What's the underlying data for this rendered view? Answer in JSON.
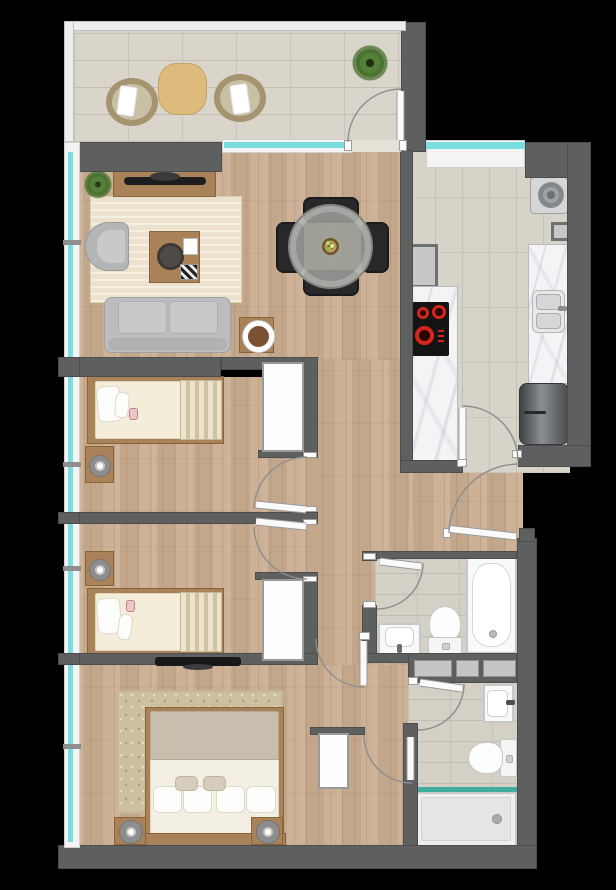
{
  "meta": {
    "title": "apartment-floor-plan",
    "view": "top-down 2D architectural floor plan with rendered furniture",
    "canvas_px": "616x890",
    "background": "#000000",
    "visible_text": ""
  },
  "palette": {
    "wall": "#5e5f5f",
    "wood_floor": "#c9ad90",
    "living_rug": "#ebe1cc",
    "balcony_tile": "#d9d5cb",
    "kitchen_tile": "#d7d3c9",
    "bathroom_tile": "#d4d0c6",
    "window_glass_cyan": "#7adde0",
    "fixture_white": "#f8f9f9",
    "furniture_wood": "#a9825a",
    "sofa_gray": "#bcbdbf",
    "dining_chair_black": "#28282a",
    "hob_burner_red": "#d5261b",
    "shower_screen_teal": "#3fae9f",
    "plant_green": "#55803a"
  },
  "rooms": [
    {
      "name": "balcony",
      "position": "top",
      "items": [
        "rattan armchair with white cushion",
        "round wooden bistro table",
        "rattan armchair with white cushion",
        "potted plant"
      ]
    },
    {
      "name": "living-dining-room",
      "position": "upper-left",
      "items": [
        "tv-sideboard with flat tv",
        "potted plant",
        "striped area rug",
        "gray armchair",
        "wooden coffee table with tray and books",
        "gray three-seat sofa",
        "round wooden side table with bowl",
        "round glass dining table with centerpiece",
        "four black dining chairs"
      ]
    },
    {
      "name": "kitchen",
      "position": "upper-right",
      "items": [
        "washing machine",
        "wall duct shaft",
        "marble worktop with black ceramic hob",
        "marble worktop with stainless double sink",
        "stainless refrigerator"
      ]
    },
    {
      "name": "bedroom-1",
      "position": "middle-left",
      "items": [
        "single bed with striped runner",
        "nightstand with reading lamp",
        "built-in white wardrobe"
      ]
    },
    {
      "name": "bedroom-2",
      "position": "lower-middle-left",
      "items": [
        "single bed with striped runner",
        "nightstand with reading lamp",
        "built-in white wardrobe"
      ]
    },
    {
      "name": "master-bedroom",
      "position": "bottom-left",
      "items": [
        "double bed with gray throw and four pillows",
        "two nightstands with lamps",
        "patterned area rug",
        "wall-mounted tv",
        "white wardrobe"
      ]
    },
    {
      "name": "bathroom-1",
      "position": "right-middle",
      "items": [
        "bathtub",
        "toilet",
        "washbasin"
      ]
    },
    {
      "name": "bathroom-2",
      "position": "bottom-right",
      "items": [
        "washbasin",
        "toilet",
        "shower tray with teal glass screen"
      ]
    },
    {
      "name": "hallway",
      "position": "center",
      "items": [
        "technical shaft with three service boxes"
      ]
    }
  ],
  "doors": [
    {
      "name": "balcony-door",
      "swings_to": "balcony"
    },
    {
      "name": "bedroom-1-door",
      "swings_to": "bedroom-1"
    },
    {
      "name": "bedroom-2-door",
      "swings_to": "bedroom-2"
    },
    {
      "name": "kitchen-door",
      "swings_to": "kitchen"
    },
    {
      "name": "entrance-door",
      "swings_to": "hallway"
    },
    {
      "name": "bathroom-1-door",
      "swings_to": "bathroom-1"
    },
    {
      "name": "corridor-door",
      "swings_to": "corridor"
    },
    {
      "name": "master-bedroom-door",
      "swings_to": "master-bedroom"
    },
    {
      "name": "bathroom-2-door",
      "swings_to": "bathroom-2"
    }
  ],
  "windows": [
    "west-facade continuous glazing",
    "living-room-to-balcony sliding window",
    "kitchen north window"
  ]
}
